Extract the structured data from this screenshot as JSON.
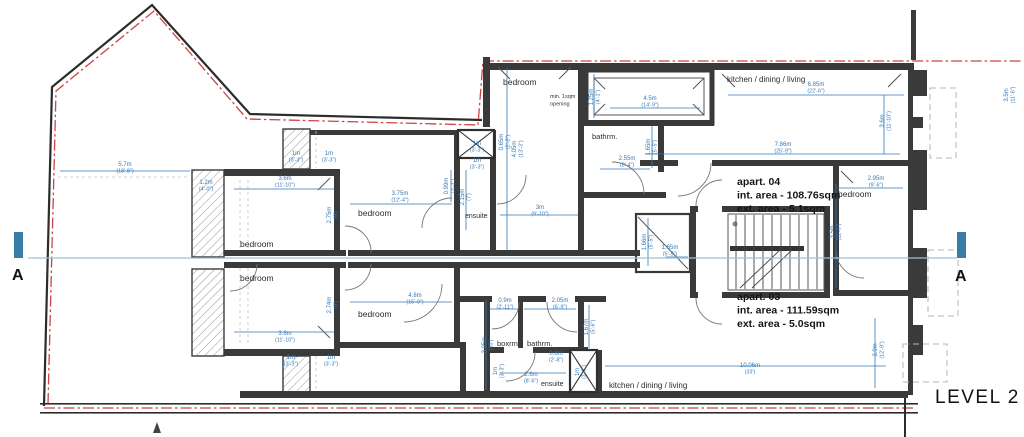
{
  "title": {
    "text": "LEVEL 2"
  },
  "section_markers": {
    "left": "A",
    "right": "A"
  },
  "apartments": [
    {
      "name": "apart. 04",
      "int": "int. area - 108.76sqm",
      "ext": "ext. area - 5.1sqm",
      "x": 737,
      "y": 185
    },
    {
      "name": "apart. 03",
      "int": "int. area - 111.59sqm",
      "ext": "ext. area - 5.0sqm",
      "x": 737,
      "y": 300
    }
  ],
  "note": {
    "lines": [
      "min. 1sqm",
      "opening"
    ],
    "x": 550,
    "y": 98
  },
  "room_labels": [
    {
      "text": "bedroom",
      "x": 240,
      "y": 247,
      "size": 8.5
    },
    {
      "text": "bedroom",
      "x": 240,
      "y": 281,
      "size": 8.5
    },
    {
      "text": "bedroom",
      "x": 358,
      "y": 216,
      "size": 8.5
    },
    {
      "text": "bedroom",
      "x": 358,
      "y": 317,
      "size": 8.5
    },
    {
      "text": "bedroom",
      "x": 503,
      "y": 85,
      "size": 8.5
    },
    {
      "text": "bedroom",
      "x": 838,
      "y": 197,
      "size": 8.5
    },
    {
      "text": "ensuite",
      "x": 465,
      "y": 218,
      "size": 7
    },
    {
      "text": "ensuite",
      "x": 541,
      "y": 386,
      "size": 7
    },
    {
      "text": "bathrm.",
      "x": 592,
      "y": 139,
      "size": 7.5
    },
    {
      "text": "bathrm.",
      "x": 527,
      "y": 346,
      "size": 7.5
    },
    {
      "text": "boxrm.",
      "x": 497,
      "y": 346,
      "size": 7.5
    },
    {
      "text": "kitchen / dining / living",
      "x": 727,
      "y": 82,
      "size": 8
    },
    {
      "text": "kitchen / dining / living",
      "x": 609,
      "y": 388,
      "size": 8
    }
  ],
  "dimensions": [
    {
      "m": "5.7m",
      "ft": "(18'-8\")",
      "x": 125,
      "y": 166
    },
    {
      "m": "1.2m",
      "ft": "(4'-0\")",
      "x": 206,
      "y": 184
    },
    {
      "m": "3.6m",
      "ft": "(11'-10\")",
      "x": 285,
      "y": 180
    },
    {
      "m": "1m",
      "ft": "(3'-3\")",
      "x": 296,
      "y": 155
    },
    {
      "m": "1m",
      "ft": "(3'-3\")",
      "x": 329,
      "y": 155
    },
    {
      "m": "3.75m",
      "ft": "(12'-4\")",
      "x": 400,
      "y": 195
    },
    {
      "m": "0.99m",
      "ft": "(3'-3\")",
      "x": 448,
      "y": 186,
      "rot": -90
    },
    {
      "m": "1m",
      "ft": "(3'-3\")",
      "x": 477,
      "y": 145
    },
    {
      "m": "1m",
      "ft": "(3'-3\")",
      "x": 477,
      "y": 162
    },
    {
      "m": "2.15m",
      "ft": "(7')",
      "x": 464,
      "y": 197,
      "rot": -90
    },
    {
      "m": "0.65m",
      "ft": "(2'-2\")",
      "x": 503,
      "y": 142,
      "rot": -90
    },
    {
      "m": "4.05m",
      "ft": "(13'-3\")",
      "x": 516,
      "y": 149,
      "rot": -90
    },
    {
      "m": "3m",
      "ft": "(9'-10\")",
      "x": 540,
      "y": 209
    },
    {
      "m": "1.25m",
      "ft": "(4'-1\")",
      "x": 593,
      "y": 97,
      "rot": -90
    },
    {
      "m": "4.5m",
      "ft": "(14'-9\")",
      "x": 650,
      "y": 100
    },
    {
      "m": "2.55m",
      "ft": "(8'-4\")",
      "x": 627,
      "y": 160
    },
    {
      "m": "1.65m",
      "ft": "(5'-5\")",
      "x": 650,
      "y": 147,
      "rot": -90
    },
    {
      "m": "6.85m",
      "ft": "(22'-6\")",
      "x": 816,
      "y": 86
    },
    {
      "m": "3.6m",
      "ft": "(11'-10\")",
      "x": 884,
      "y": 121,
      "rot": -90
    },
    {
      "m": "7.86m",
      "ft": "(25'-9\")",
      "x": 783,
      "y": 146
    },
    {
      "m": "2.95m",
      "ft": "(9'-6\")",
      "x": 876,
      "y": 180
    },
    {
      "m": "3.5m",
      "ft": "(11'-6\")",
      "x": 834,
      "y": 232,
      "rot": -90
    },
    {
      "m": "1.66m",
      "ft": "(5'-5\")",
      "x": 646,
      "y": 242,
      "rot": -90
    },
    {
      "m": "1.65m",
      "ft": "(5'-5\")",
      "x": 670,
      "y": 249
    },
    {
      "m": "2.75m",
      "ft": "(9')",
      "x": 331,
      "y": 215,
      "rot": -90
    },
    {
      "m": "2.74m",
      "ft": "(9')",
      "x": 331,
      "y": 305,
      "rot": -90
    },
    {
      "m": "3.6m",
      "ft": "(11'-10\")",
      "x": 285,
      "y": 335
    },
    {
      "m": "1m",
      "ft": "(3'-3\")",
      "x": 291,
      "y": 359
    },
    {
      "m": "1m",
      "ft": "(3'-3\")",
      "x": 331,
      "y": 359
    },
    {
      "m": "4.8m",
      "ft": "(15'-9\")",
      "x": 415,
      "y": 297
    },
    {
      "m": "0.9m",
      "ft": "(2'-11\")",
      "x": 505,
      "y": 302
    },
    {
      "m": "2.05m",
      "ft": "(6'-9\")",
      "x": 560,
      "y": 302
    },
    {
      "m": "3.05m",
      "ft": "(10')",
      "x": 486,
      "y": 345,
      "rot": -90
    },
    {
      "m": "1.67m",
      "ft": "(5'-6\")",
      "x": 588,
      "y": 327,
      "rot": -90
    },
    {
      "m": "1m",
      "ft": "(3'-3\")",
      "x": 497,
      "y": 371,
      "rot": -90
    },
    {
      "m": "2.6m",
      "ft": "(8'-6\")",
      "x": 531,
      "y": 376
    },
    {
      "m": "0.8m",
      "ft": "(2'-8\")",
      "x": 556,
      "y": 355
    },
    {
      "m": "1m",
      "ft": "(3'-3\")",
      "x": 579,
      "y": 372,
      "rot": -90
    },
    {
      "m": "10.06m",
      "ft": "(33')",
      "x": 750,
      "y": 367
    },
    {
      "m": "3.9m",
      "ft": "(12'-9\")",
      "x": 877,
      "y": 350,
      "rot": -90
    },
    {
      "m": "3.5m",
      "ft": "(11'-6\")",
      "x": 1008,
      "y": 95,
      "rot": -90
    }
  ],
  "colors": {
    "dimension_blue": "#3579b8",
    "boundary_red": "#cc4343",
    "wall_dark": "#3a3a3a",
    "section_blue": "#3a7ca8",
    "hatch_gray": "#999999",
    "dashed_gray": "#b5b5b5"
  }
}
